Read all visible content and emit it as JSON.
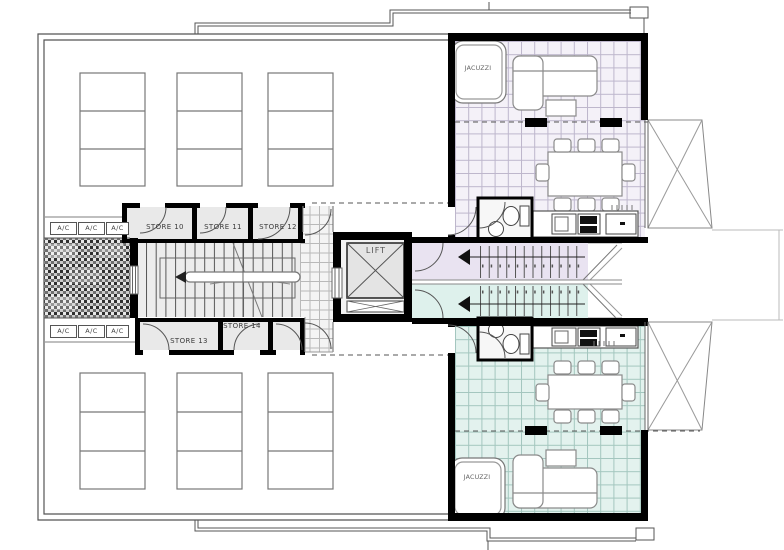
{
  "labels": {
    "lift": "LIFT",
    "jacuzzi": "JACUZZI",
    "ac_unit": "A/C",
    "store_rooms": [
      "STORE 10",
      "STORE 11",
      "STORE 12",
      "STORE 13",
      "STORE 14"
    ]
  },
  "colors": {
    "wall": "#000000",
    "line": "#555555",
    "lite": "#999999",
    "store_fill": "#e9e9e9",
    "stair_fill": "#ececec",
    "corridor_top": "#e9e3f1",
    "corridor_bottom": "#def1ec",
    "apt_top_floor": "#f4f1f8",
    "apt_bottom_floor": "#e3f2ee",
    "tile_top_line": "#bdb6cc",
    "tile_bottom_line": "#a3c6be",
    "lobby_tile_line": "#b9b9b9",
    "hatch_bg": "#c9c9c9",
    "hatch_dark": "#2f2f2f",
    "furniture": "#8a8a8a"
  }
}
